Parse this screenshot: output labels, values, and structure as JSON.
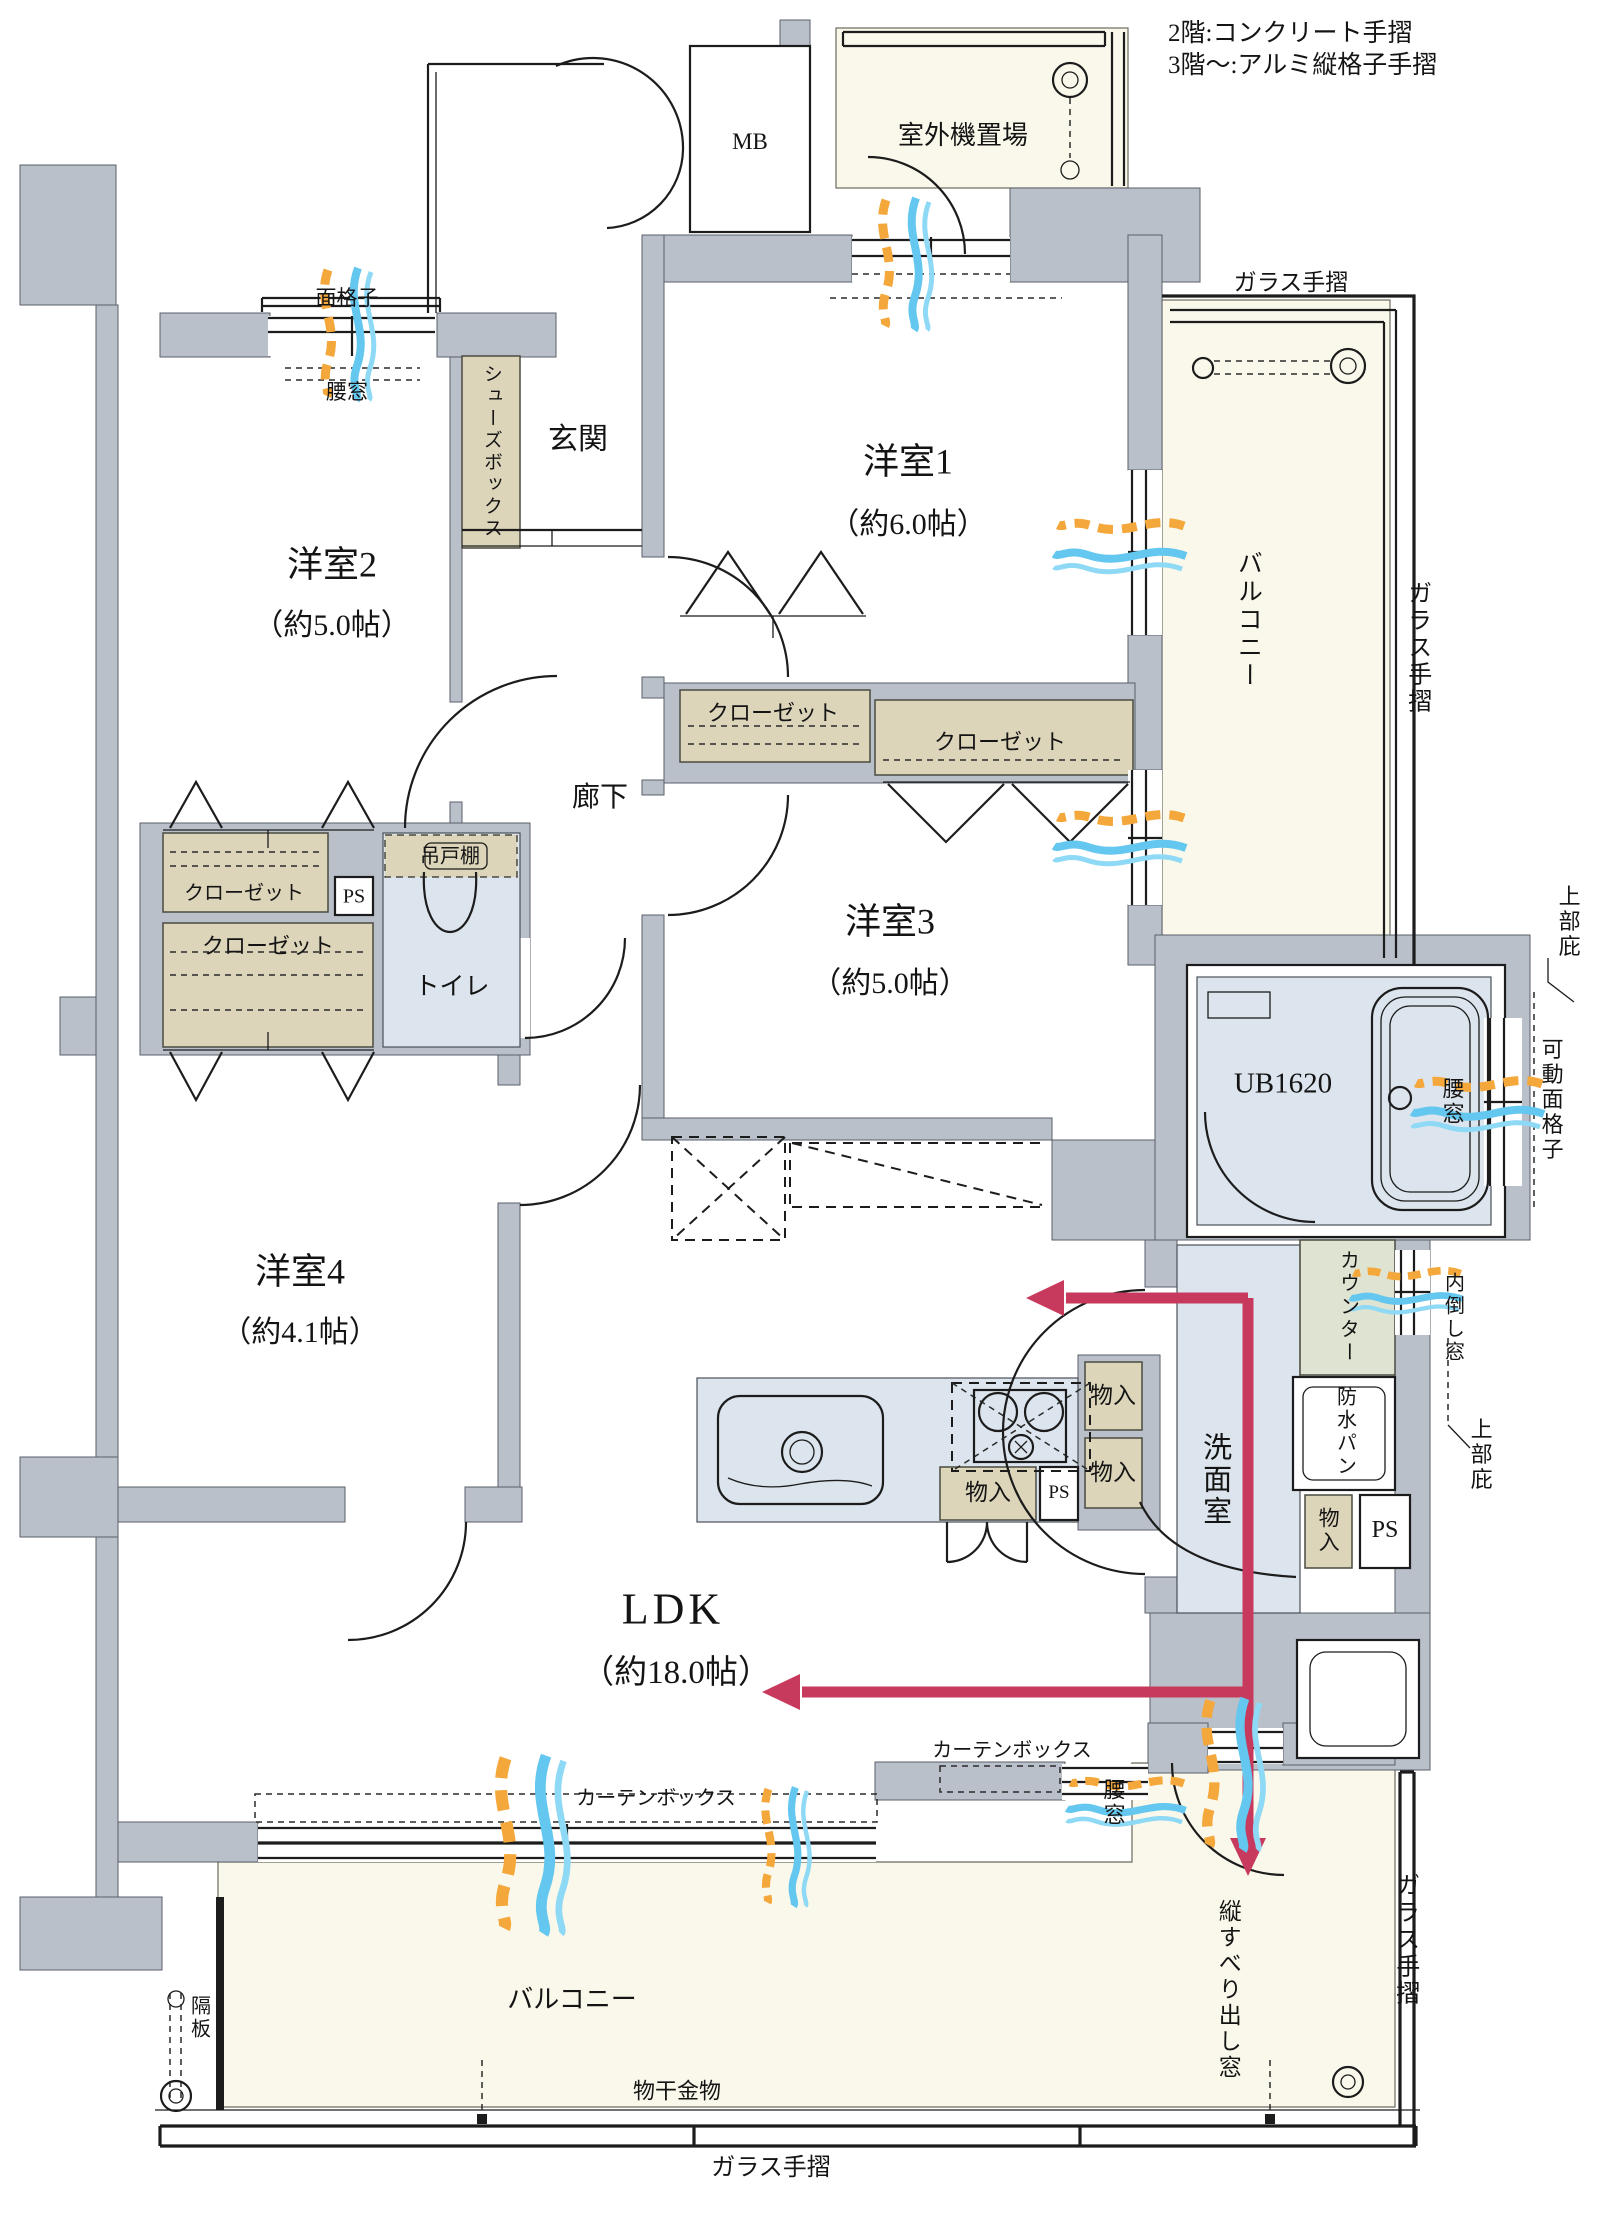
{
  "notes": {
    "floor2": "2階:コンクリート手摺",
    "floor3": "3階〜:アルミ縦格子手摺"
  },
  "rooms": {
    "western1_name": "洋室1",
    "western1_size": "（約6.0帖）",
    "western2_name": "洋室2",
    "western2_size": "（約5.0帖）",
    "western3_name": "洋室3",
    "western3_size": "（約5.0帖）",
    "western4_name": "洋室4",
    "western4_size": "（約4.1帖）",
    "ldk_name": "LDK",
    "ldk_size": "（約18.0帖）",
    "entrance": "玄関",
    "hallway": "廊下",
    "toilet": "トイレ",
    "washroom": "洗面室",
    "bath_unit": "UB1620",
    "balcony": "バルコニー",
    "outdoor_unit": "室外機置場",
    "meter_box": "MB"
  },
  "fixtures": {
    "closet": "クローゼット",
    "shoes_box": "シューズボックス",
    "hanging_cupboard": "吊戸棚",
    "storage": "物入",
    "pipe_space": "PS",
    "counter": "カウンター",
    "waterproof_pan": "防水パン",
    "laundry_hardware": "物干金物"
  },
  "annotations": {
    "lattice": "面格子",
    "waist_window": "腰窓",
    "glass_handrail": "ガラス手摺",
    "movable_lattice": "可動面格子",
    "upper_eaves": "上部庇",
    "inward_tilting_window": "内倒し窓",
    "vertical_casement_window": "縦すべり出し窓",
    "curtain_box": "カーテンボックス",
    "partition_board": "隔板"
  }
}
